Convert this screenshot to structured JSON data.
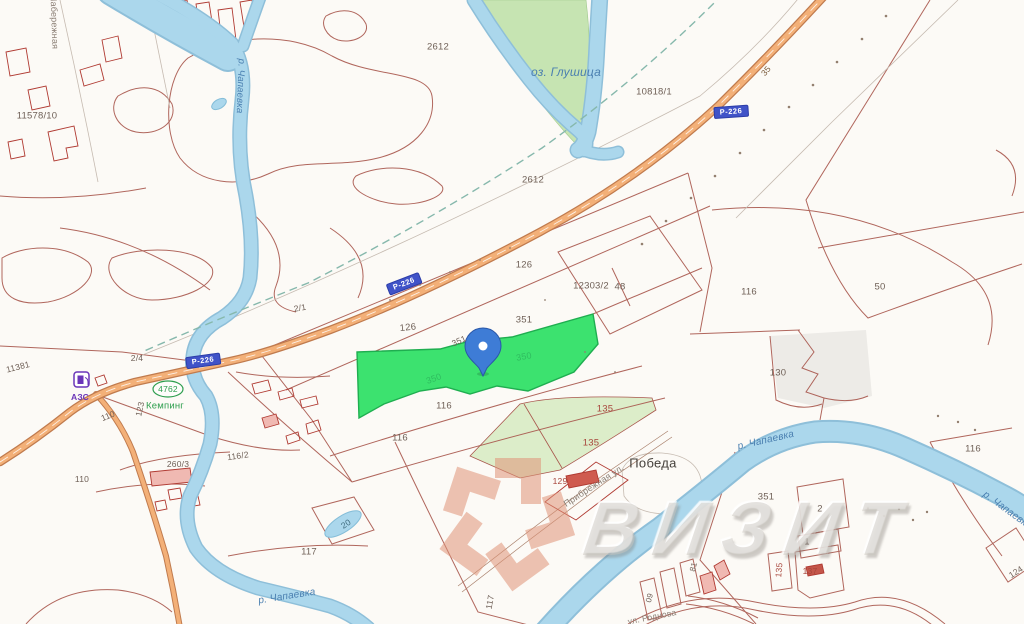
{
  "labels": {
    "street_naberezhnaya": "Набережная",
    "river_chapaevka": "р. Чапаевка",
    "lake_glushitsa": "оз. Глушица",
    "settlement_pobeda": "Победа",
    "street_pribrezhnaya": "Прибрежная ул.",
    "street_rodnova": "ул. Роднова",
    "camping_name": "Кемпинг",
    "camping_code": "4762",
    "fuel_station": "АЗС",
    "route_shield": "Р-226",
    "km_mark_35": "35",
    "p_11578_10": "11578/10",
    "p_2612": "2612",
    "p_10818_1": "10818/1",
    "p_12303_2": "12303/2",
    "p_48": "48",
    "p_50": "50",
    "p_126": "126",
    "p_351": "351",
    "p_350": "350",
    "p_116": "116",
    "p_130": "130",
    "p_135": "135",
    "p_129": "129",
    "p_137": "137",
    "p_117": "117",
    "p_110": "110",
    "p_123": "123",
    "p_11381": "11381",
    "p_2_1": "2/1",
    "p_2_4": "2/4",
    "p_260_3": "260/3",
    "p_116_2": "116/2",
    "p_20": "20",
    "p_81": "81",
    "p_09": "09",
    "p_2": "2",
    "p_1": "1",
    "p_124": "124"
  },
  "watermark": {
    "brand": "ВИЗИТ"
  },
  "colors": {
    "highlight_parcel": "#3ce26f",
    "marker_pin": "#3e7cd6",
    "river": "#abd7ec",
    "highway": "#f3b078",
    "parcel_boundary": "#a8564c",
    "watermark_logo": "#e09478",
    "route_shield_bg": "#4053c8",
    "camping_green": "#2e9e4e",
    "fuel_purple": "#6a35b8"
  }
}
